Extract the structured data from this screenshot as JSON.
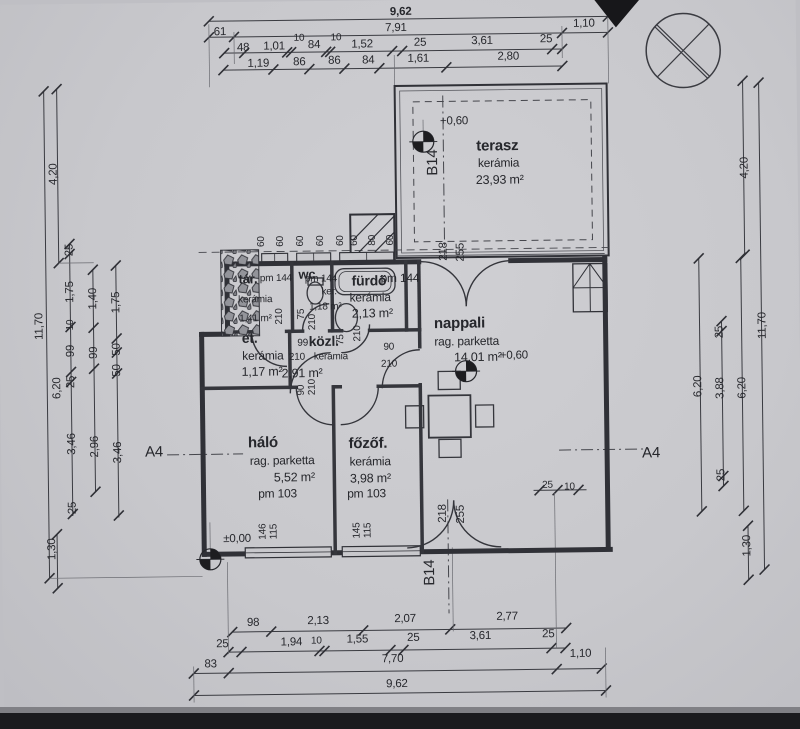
{
  "rooms": {
    "terasz": {
      "name": "terasz",
      "finish": "kerámia",
      "area": "23,93 m²"
    },
    "nappali": {
      "name": "nappali",
      "finish": "rag. parketta",
      "area": "14,01 m²"
    },
    "halo": {
      "name": "háló",
      "finish": "rag. parketta",
      "area": "5,52 m²",
      "pm": "pm 103"
    },
    "fozof": {
      "name": "főzőf.",
      "finish": "kerámia",
      "area": "3,98 m²",
      "pm": "pm 103"
    },
    "furdo": {
      "name": "fürdő",
      "finish": "kerámia",
      "area": "2,13 m²",
      "pm": "pm 144"
    },
    "wc": {
      "name": "wc",
      "finish": "ker.",
      "area": "1,18 m²",
      "pm": "pm 144"
    },
    "tar": {
      "name": "tár.",
      "finish": "kerámia",
      "area": "1,41 m²",
      "pm": "pm 144"
    },
    "et": {
      "name": "et.",
      "finish": "kerámia",
      "area": "1,17 m²"
    },
    "kozl": {
      "name": "közl.",
      "finish": "kerámia",
      "area": "2,91 m²"
    }
  },
  "levels": {
    "zero": "±0,00",
    "terrace": "+0,60",
    "nappali": "+0,60"
  },
  "markers": {
    "a4": "A4",
    "b14": "B14"
  },
  "dims": {
    "top": {
      "r1": [
        "9,62"
      ],
      "r2": [
        "61",
        "7,91",
        "1,10"
      ],
      "r3": [
        "48",
        "1,01",
        "10",
        "84",
        "10",
        "1,52",
        "25",
        "3,61",
        "25"
      ],
      "r4": [
        "1,19",
        "86",
        "86",
        "84",
        "1,61",
        "2,80"
      ]
    },
    "bottom": {
      "r1": [
        "98",
        "2,13",
        "2,07",
        "2,77"
      ],
      "r2": [
        "25",
        "1,94",
        "10",
        "1,55",
        "25",
        "3,61",
        "25"
      ],
      "r3": [
        "83",
        "7,70",
        "1,10"
      ],
      "r4": [
        "9,62"
      ]
    },
    "left": {
      "outer": [
        "4,20",
        "11,70",
        "1,30"
      ],
      "mid": [
        "6,20"
      ],
      "c1": [
        "25",
        "1,75",
        "10",
        "99",
        "25",
        "3,46",
        "25"
      ],
      "c2": [
        "1,40",
        "99",
        "2,96"
      ],
      "c3": [
        "1,75",
        "50",
        "50",
        "3,46"
      ]
    },
    "right": {
      "outer": [
        "4,20",
        "11,70",
        "1,30"
      ],
      "c1": [
        "6,20"
      ],
      "c2": [
        "25",
        "3,88",
        "25"
      ],
      "c3": [
        "6,20"
      ],
      "extra": [
        "25",
        "10"
      ]
    },
    "eaves": [
      "60",
      "60",
      "60",
      "60",
      "60",
      "60",
      "80",
      "60"
    ],
    "openings": {
      "door_kozl": [
        "99",
        "210"
      ],
      "door_nappali": [
        "90",
        "210"
      ],
      "door_halo": [
        "90",
        "210"
      ],
      "door_fozof": [
        "75",
        "210"
      ],
      "door_wc": [
        "75",
        "210"
      ],
      "door_tar": [
        "210"
      ],
      "french_top": [
        "218",
        "255"
      ],
      "french_bottom": [
        "218",
        "255"
      ],
      "win_halo": [
        "146",
        "115"
      ],
      "win_fozof": [
        "145",
        "115"
      ]
    }
  }
}
